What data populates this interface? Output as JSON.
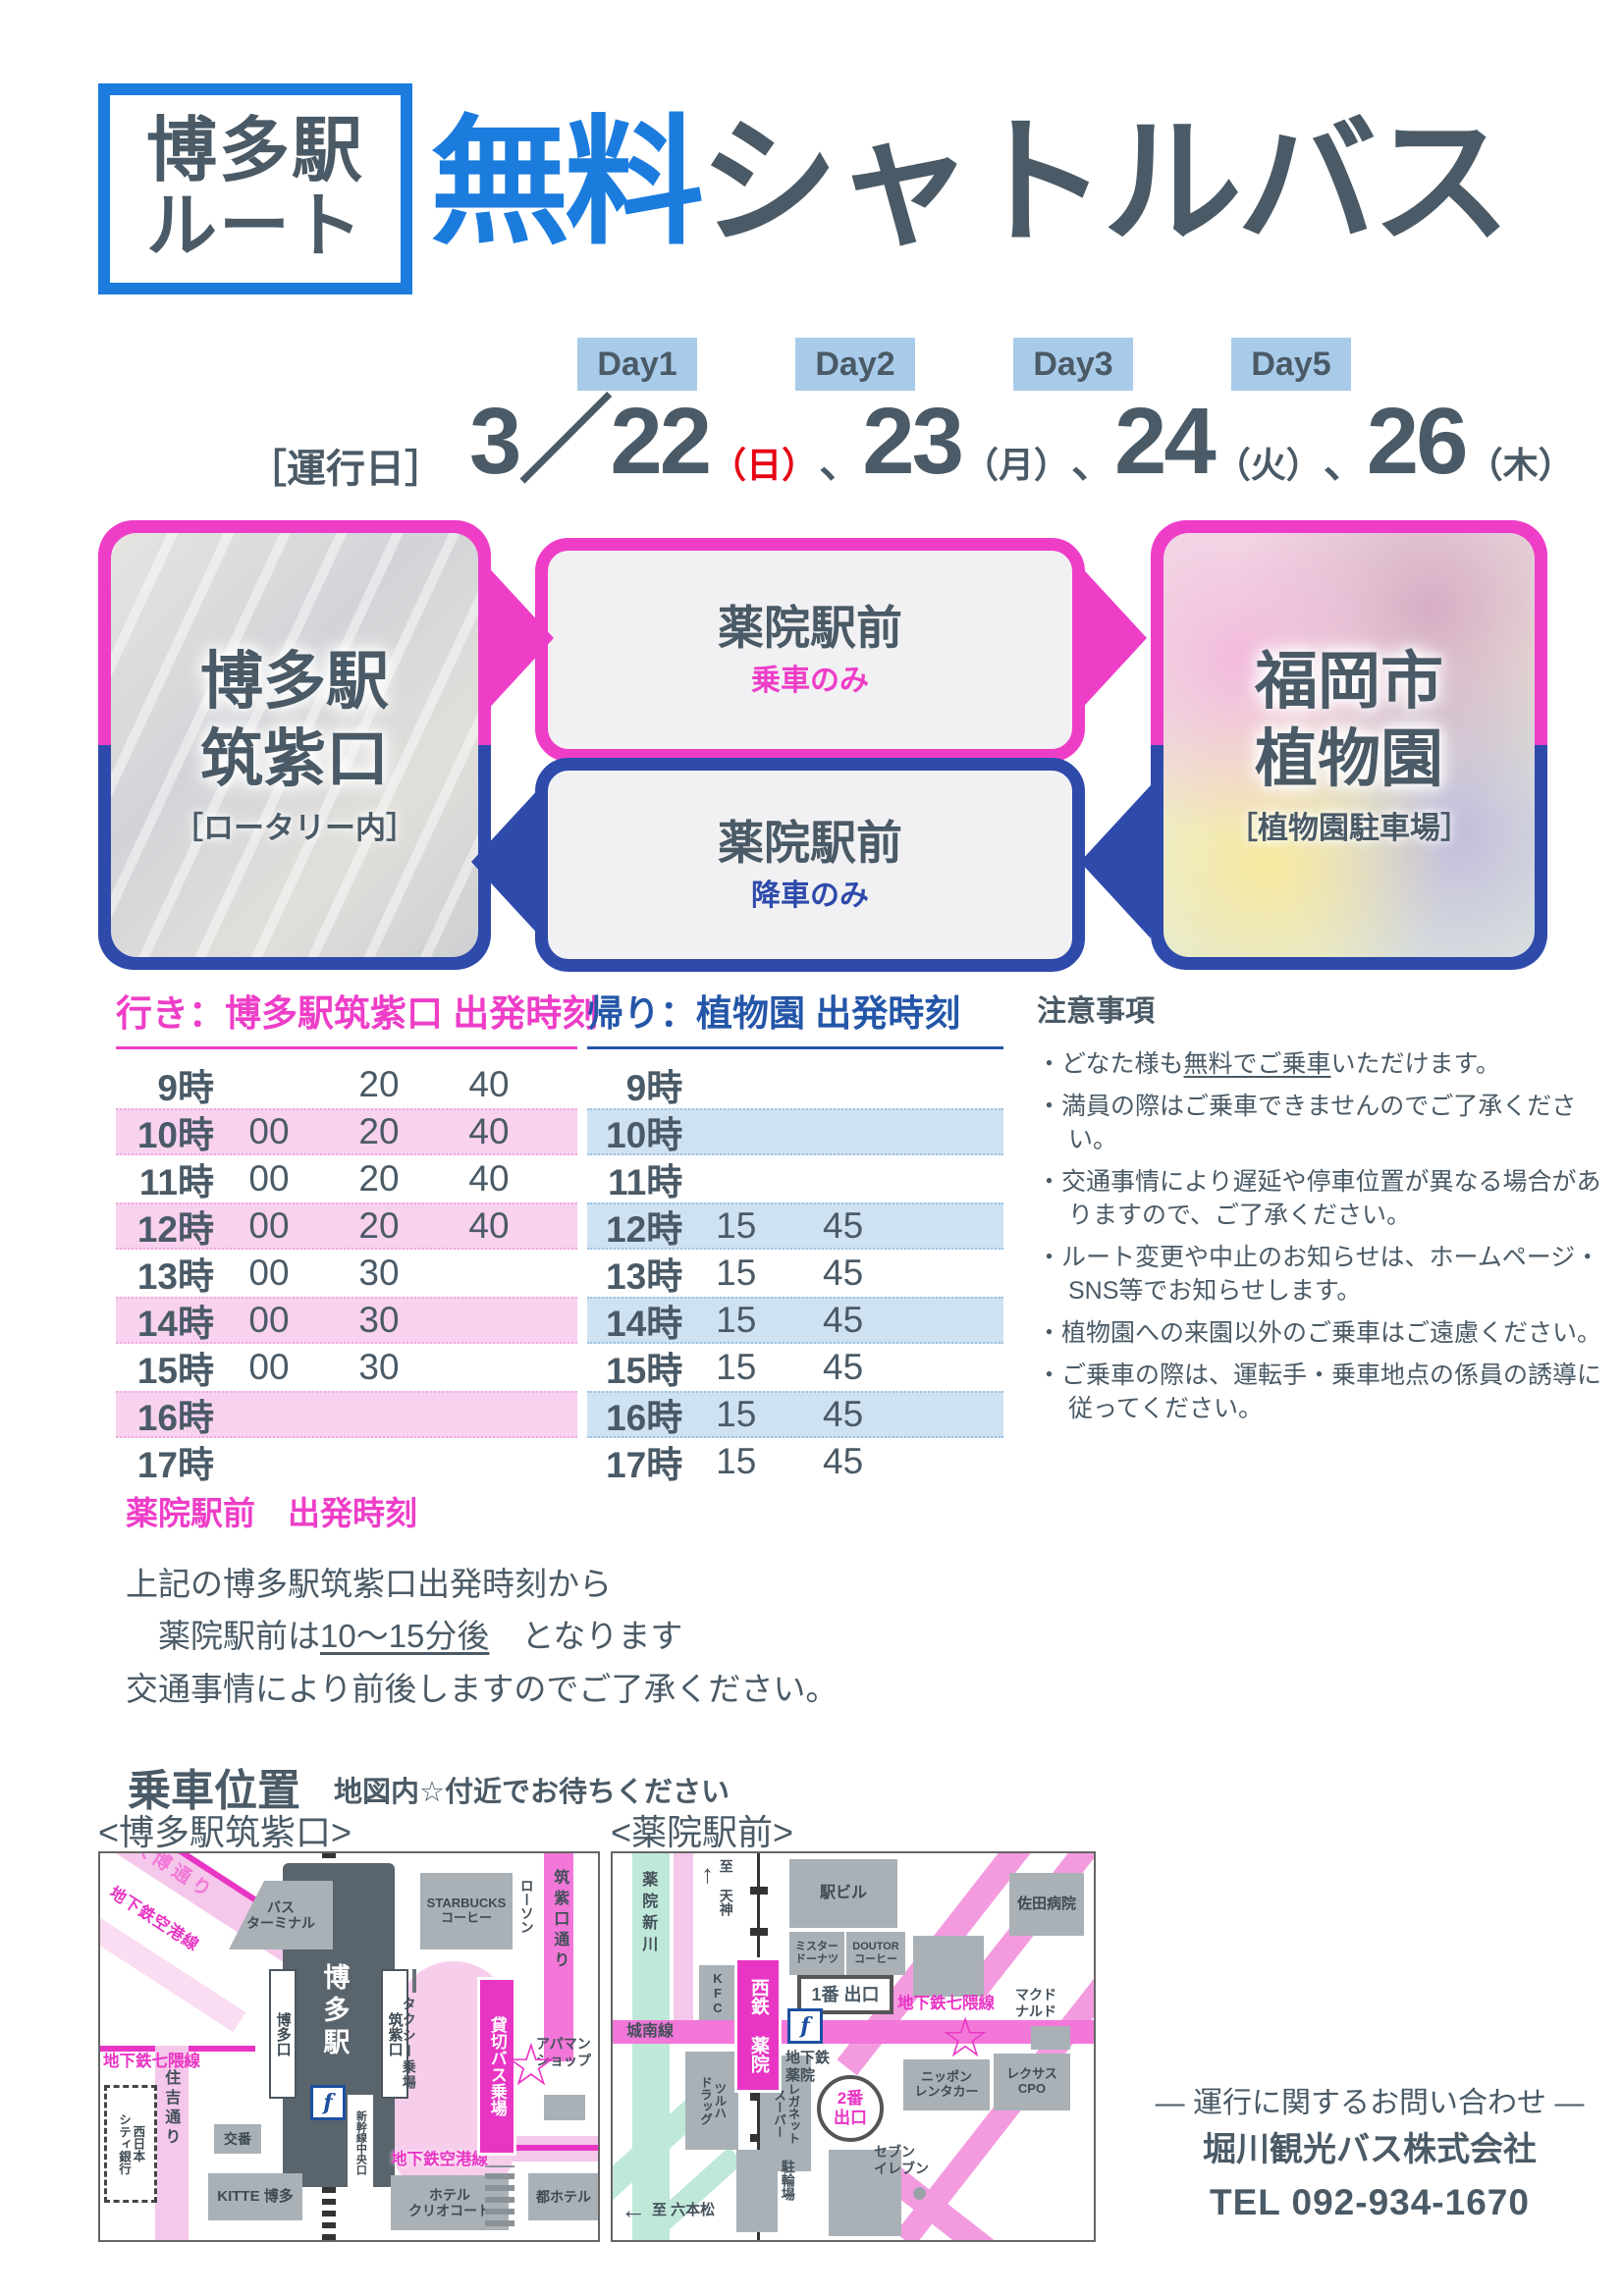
{
  "colors": {
    "blue": "#1B7CDE",
    "slate": "#4A5A66",
    "magenta": "#EE3EC8",
    "navy": "#2E4AAB",
    "red": "#E60012",
    "daybg": "#A9CBEA",
    "pinkrow": "#F8D2EE",
    "bluerow": "#CFE2F2",
    "headblue": "#2456A8",
    "mapmagenta": "#E935C4",
    "roadpink": "#F277D8",
    "mappink": "#F5C7EA",
    "bldg": "#A9B1B7",
    "river": "#BFE8D9",
    "station": "#5A646C"
  },
  "header": {
    "badge_line1": "博多駅",
    "badge_line2": "ルート",
    "title_free": "無料",
    "title_rest": "シャトルバス"
  },
  "days": [
    "Day1",
    "Day2",
    "Day3",
    "Day5"
  ],
  "operating": {
    "label": "［運行日］",
    "separator": "、",
    "dates": [
      {
        "num": "3／22",
        "wd": "（日）"
      },
      {
        "num": "23",
        "wd": "（月）"
      },
      {
        "num": "24",
        "wd": "（火）"
      },
      {
        "num": "26",
        "wd": "（木）"
      }
    ]
  },
  "route": {
    "left": {
      "line1": "博多駅",
      "line2": "筑紫口",
      "note": "［ロータリー内］"
    },
    "mid_top": {
      "title": "薬院駅前",
      "sub": "乗車のみ"
    },
    "mid_bottom": {
      "title": "薬院駅前",
      "sub": "降車のみ"
    },
    "right": {
      "line1": "福岡市",
      "line2": "植物園",
      "note": "［植物園駐車場］"
    }
  },
  "outbound_table": {
    "title": "行き：博多駅筑紫口 出発時刻",
    "rows": [
      {
        "hour": "9時",
        "times": [
          "",
          "20",
          "40"
        ],
        "striped": false
      },
      {
        "hour": "10時",
        "times": [
          "00",
          "20",
          "40"
        ],
        "striped": true
      },
      {
        "hour": "11時",
        "times": [
          "00",
          "20",
          "40"
        ],
        "striped": false
      },
      {
        "hour": "12時",
        "times": [
          "00",
          "20",
          "40"
        ],
        "striped": true
      },
      {
        "hour": "13時",
        "times": [
          "00",
          "30",
          ""
        ],
        "striped": false
      },
      {
        "hour": "14時",
        "times": [
          "00",
          "30",
          ""
        ],
        "striped": true
      },
      {
        "hour": "15時",
        "times": [
          "00",
          "30",
          ""
        ],
        "striped": false
      },
      {
        "hour": "16時",
        "times": [
          "",
          "",
          ""
        ],
        "striped": true
      },
      {
        "hour": "17時",
        "times": [
          "",
          "",
          ""
        ],
        "striped": false
      }
    ]
  },
  "return_table": {
    "title": "帰り：植物園 出発時刻",
    "rows": [
      {
        "hour": "9時",
        "times": [
          "",
          "",
          ""
        ],
        "striped": false
      },
      {
        "hour": "10時",
        "times": [
          "",
          "",
          ""
        ],
        "striped": true
      },
      {
        "hour": "11時",
        "times": [
          "",
          "",
          ""
        ],
        "striped": false
      },
      {
        "hour": "12時",
        "times": [
          "15",
          "45",
          ""
        ],
        "striped": true
      },
      {
        "hour": "13時",
        "times": [
          "15",
          "45",
          ""
        ],
        "striped": false
      },
      {
        "hour": "14時",
        "times": [
          "15",
          "45",
          ""
        ],
        "striped": true
      },
      {
        "hour": "15時",
        "times": [
          "15",
          "45",
          ""
        ],
        "striped": false
      },
      {
        "hour": "16時",
        "times": [
          "15",
          "45",
          ""
        ],
        "striped": true
      },
      {
        "hour": "17時",
        "times": [
          "15",
          "45",
          ""
        ],
        "striped": false
      }
    ]
  },
  "notes": {
    "title": "注意事項",
    "bullet": "・",
    "items": [
      {
        "segs": [
          {
            "t": "どなた様も"
          },
          {
            "t": "無料でご乗車",
            "u": true
          },
          {
            "t": "いただけます。"
          }
        ]
      },
      {
        "segs": [
          {
            "t": "満員の際はご乗車できませんのでご了承ください。"
          }
        ]
      },
      {
        "segs": [
          {
            "t": "交通事情により遅延や停車位置が異なる場合がありますので、ご了承ください。"
          }
        ]
      },
      {
        "segs": [
          {
            "t": "ルート変更や中止のお知らせは、ホームページ・SNS等でお知らせします。"
          }
        ]
      },
      {
        "segs": [
          {
            "t": "植物園への来園以外のご乗車はご遠慮ください。"
          }
        ]
      },
      {
        "segs": [
          {
            "t": "ご乗車の際は、運転手・乗車地点の係員の誘導に従ってください。"
          }
        ]
      }
    ]
  },
  "yakuin_info": {
    "title": "薬院駅前　出発時刻",
    "line1": "上記の博多駅筑紫口出発時刻から",
    "line2_pre": "　薬院駅前は",
    "line2_u": "10～15分後",
    "line2_post": "　となります",
    "line3": "交通事情により前後しますのでご了承ください。"
  },
  "boarding": {
    "title": "乗車位置",
    "subtitle": "地図内☆付近でお待ちください",
    "left_caption": "<博多駅筑紫口>",
    "right_caption": "<薬院駅前>"
  },
  "maps": {
    "hakata": {
      "labels": {
        "daihaku": "大博通り",
        "kuko_diag": "地下鉄空港線",
        "bus_terminal": "バス\nターミナル",
        "starbucks": "STARBUCKS\nコーヒー",
        "lawson": "ローソン",
        "chikushi_dori": "筑紫口通り",
        "station": "博多駅",
        "exit_hakata": "博多口",
        "exit_chikushi": "筑紫口",
        "shinkansen": "新幹線中央口",
        "taxi": "タクシー乗場",
        "charter": "貸切バス乗場",
        "star": "☆",
        "flogo": "f",
        "apaman": "アパマン\nショップ",
        "nanakuma": "地下鉄七隈線",
        "sumiyoshi": "住吉通り",
        "bank": "西日本\nシティ銀行",
        "koban": "交番",
        "kitte": "KITTE 博多",
        "kuko_bottom": "地下鉄空港線",
        "hotel_clio": "ホテル\nクリオコート",
        "miyako": "都ホテル"
      }
    },
    "yakuin": {
      "labels": {
        "shinkawa": "薬院新川",
        "to_tenjin": "至 天神",
        "tenjin_arrow": "↑",
        "ekibiru": "駅ビル",
        "mister": "ミスター\nドーナツ",
        "doutor": "DOUTOR\nコーヒー",
        "sada": "佐田病院",
        "kfc": "KFC",
        "nishitetsu": "西鉄 薬院",
        "exit1": "1番 出口",
        "jonan": "城南線",
        "nanakuma": "地下鉄七隈線",
        "chika_yakuin": "地下鉄\n薬院",
        "star": "☆",
        "flogo": "f",
        "tsuruha": "ツルハ\nドラッグ",
        "reganet": "レガネット\nスーパー",
        "exit2": "2番\n出口",
        "nippon": "ニッポン\nレンタカー",
        "lexus": "レクサス\nCPO",
        "mcd": "マクド\nナルド",
        "seven": "セブン\nイレブン",
        "churinjo": "駐輪場",
        "to_ropponmatsu": "至 六本松",
        "ropponmatsu_arrow": "←"
      }
    }
  },
  "contact": {
    "line1": "― 運行に関するお問い合わせ ―",
    "line2": "堀川観光バス株式会社",
    "line3": "TEL 092-934-1670"
  }
}
